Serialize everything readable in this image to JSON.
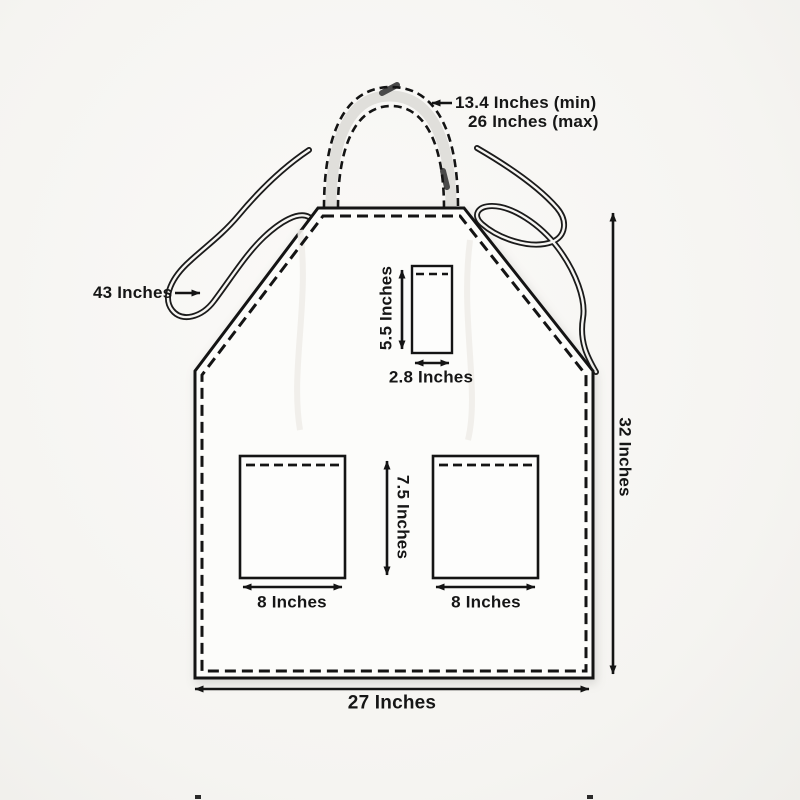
{
  "figure": {
    "name": "Apron size chart diagram",
    "background_color": "#f5f4f1",
    "line_color": "#141414",
    "apron_fill": "#fcfcfa",
    "strap_shade_color": "#d9d8d5",
    "text_color": "#161616"
  },
  "labels": {
    "neck_strap_min": "13.4 Inches (min)",
    "neck_strap_max": "26 Inches (max)",
    "waist_tie_length": "43 Inches",
    "chest_pocket_height": "5.5 Inches",
    "chest_pocket_width": "2.8 Inches",
    "lower_pocket_height": "7.5 Inches",
    "lower_pocket_left_width": "8 Inches",
    "lower_pocket_right_width": "8 Inches",
    "apron_length": "32 Inches",
    "apron_width": "27 Inches"
  }
}
